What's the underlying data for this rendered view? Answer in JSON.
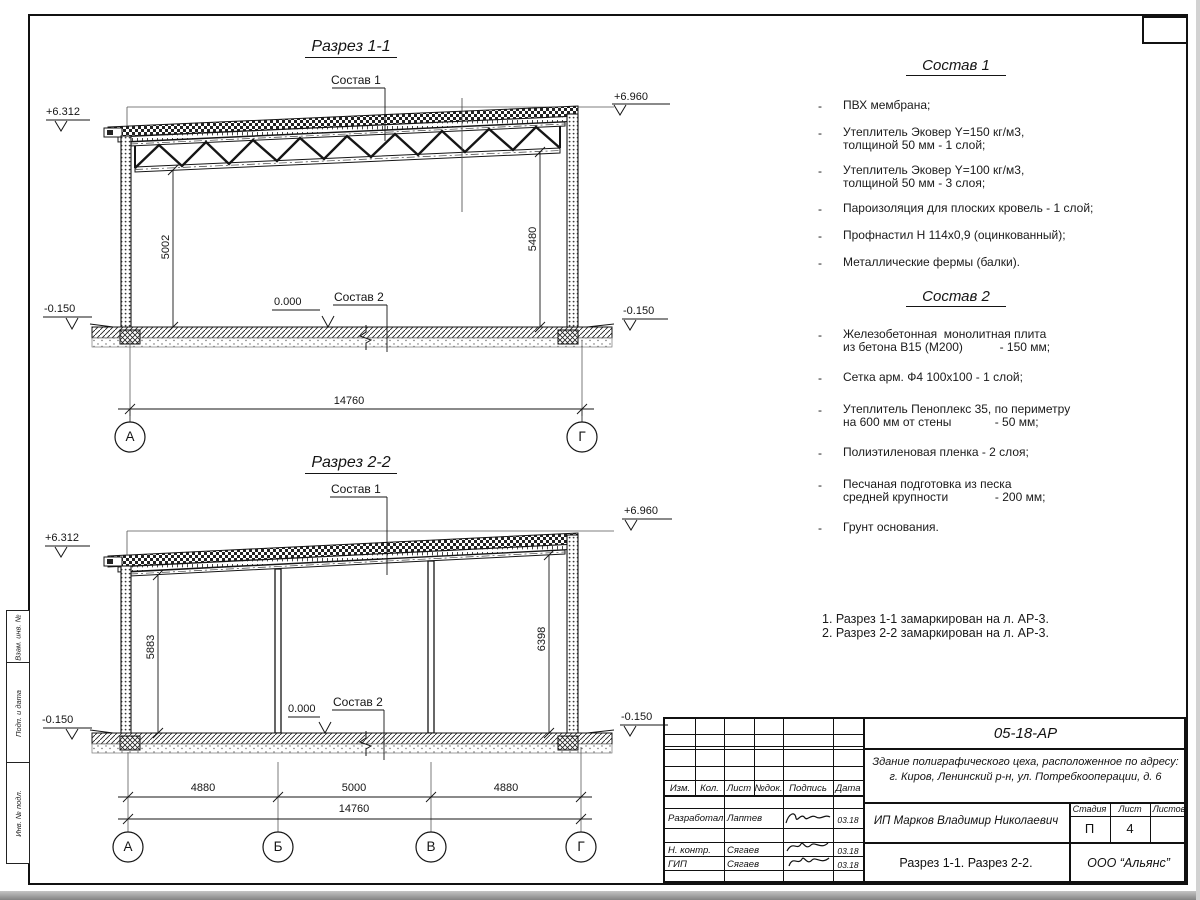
{
  "margin_fields": {
    "f1": "Взам. инв. №",
    "f2": "Подп. и дата",
    "f3": "Инв. № подл."
  },
  "sec1": {
    "title": "Разрез 1-1",
    "callout_roof": "Состав 1",
    "callout_floor": "Состав 2",
    "elev_top_left": "+6.312",
    "elev_top_right": "+6.960",
    "elev_zero": "0.000",
    "elev_low_left": "-0.150",
    "elev_low_right": "-0.150",
    "dim_left": "5002",
    "dim_right": "5480",
    "dim_span": "14760",
    "axis_a": "А",
    "axis_g": "Г"
  },
  "sec2": {
    "title": "Разрез 2-2",
    "callout_roof": "Состав 1",
    "callout_floor": "Состав 2",
    "elev_top_left": "+6.312",
    "elev_top_right": "+6.960",
    "elev_zero": "0.000",
    "elev_low_left": "-0.150",
    "elev_low_right": "-0.150",
    "dim_left": "5883",
    "dim_right": "6398",
    "span1": "4880",
    "span2": "5000",
    "span3": "4880",
    "dim_span": "14760",
    "axis_a": "А",
    "axis_b": "Б",
    "axis_v": "В",
    "axis_g": "Г"
  },
  "sostav1": {
    "title": "Состав 1",
    "bullet": "-",
    "items": [
      "ПВХ мембрана;",
      "Утеплитель Эковер Y=150 кг/м3,\nтолщиной 50 мм - 1 слой;",
      "Утеплитель Эковер Y=100 кг/м3,\nтолщиной 50 мм - 3 слоя;",
      "Пароизоляция для плоских кровель - 1 слой;",
      "Профнастил Н 114х0,9 (оцинкованный);",
      "Металлические фермы (балки)."
    ]
  },
  "sostav2": {
    "title": "Состав 2",
    "bullet": "-",
    "items": [
      "Железобетонная  монолитная плита\nиз бетона В15 (М200)           - 150 мм;",
      "Сетка арм. Ф4 100х100 - 1 слой;",
      "Утеплитель Пеноплекс 35, по периметру\nна 600 мм от стены             - 50 мм;",
      "Полиэтиленовая пленка - 2 слоя;",
      "Песчаная подготовка из песка\nсредней крупности              - 200 мм;",
      "Грунт основания."
    ]
  },
  "notes": {
    "n1": "1. Разрез 1-1 замаркирован на л. АР-3.",
    "n2": "2. Разрез 2-2 замаркирован на л. АР-3."
  },
  "titleblock": {
    "doc": "05-18-АР",
    "obj1": "Здание полиграфического цеха, расположенное по адресу:",
    "obj2": "г. Киров,  Ленинский р-н, ул. Потребкооперации, д. 6",
    "client": "ИП Марков Владимир Николаевич",
    "sheet_name": "Разрез 1-1. Разрез 2-2.",
    "org": "ООО “Альянс”",
    "h_izm": "Изм.",
    "h_kol": "Кол.",
    "h_list": "Лист",
    "h_doc": "№док.",
    "h_sign": "Подпись",
    "h_date": "Дата",
    "h_stage": "Стадия",
    "h_sheet": "Лист",
    "h_sheets": "Листов",
    "stage": "П",
    "sheet_no": "4",
    "sheets_total": "",
    "r1_role": "Разработал",
    "r1_name": "Лаптев",
    "r1_date": "03.18",
    "r2_role": "Н. контр.",
    "r2_name": "Сягаев",
    "r2_date": "03.18",
    "r3_role": "ГИП",
    "r3_name": "Сягаев",
    "r3_date": "03.18"
  }
}
